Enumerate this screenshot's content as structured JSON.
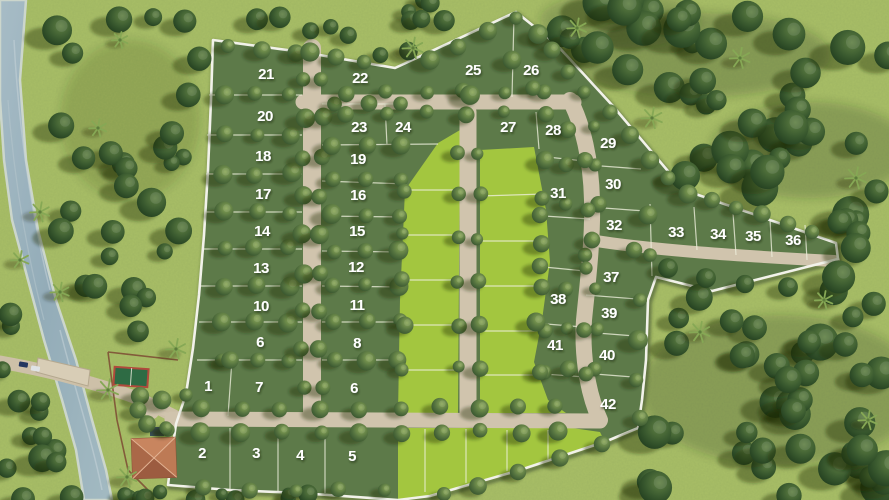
{
  "map": {
    "lot_labels": [
      {
        "label": "1",
        "x": 208,
        "y": 391
      },
      {
        "label": "2",
        "x": 202,
        "y": 458
      },
      {
        "label": "3",
        "x": 256,
        "y": 458
      },
      {
        "label": "4",
        "x": 300,
        "y": 460
      },
      {
        "label": "5",
        "x": 352,
        "y": 461
      },
      {
        "label": "6",
        "x": 260,
        "y": 347
      },
      {
        "label": "6",
        "x": 354,
        "y": 393
      },
      {
        "label": "7",
        "x": 259,
        "y": 392
      },
      {
        "label": "8",
        "x": 357,
        "y": 348
      },
      {
        "label": "10",
        "x": 261,
        "y": 311
      },
      {
        "label": "11",
        "x": 357,
        "y": 310
      },
      {
        "label": "12",
        "x": 356,
        "y": 272
      },
      {
        "label": "13",
        "x": 261,
        "y": 273
      },
      {
        "label": "14",
        "x": 262,
        "y": 236
      },
      {
        "label": "15",
        "x": 357,
        "y": 236
      },
      {
        "label": "16",
        "x": 358,
        "y": 200
      },
      {
        "label": "17",
        "x": 263,
        "y": 199
      },
      {
        "label": "18",
        "x": 263,
        "y": 161
      },
      {
        "label": "19",
        "x": 358,
        "y": 164
      },
      {
        "label": "20",
        "x": 265,
        "y": 121
      },
      {
        "label": "21",
        "x": 266,
        "y": 79
      },
      {
        "label": "22",
        "x": 360,
        "y": 83
      },
      {
        "label": "23",
        "x": 359,
        "y": 132
      },
      {
        "label": "24",
        "x": 403,
        "y": 132
      },
      {
        "label": "25",
        "x": 473,
        "y": 75
      },
      {
        "label": "26",
        "x": 531,
        "y": 75
      },
      {
        "label": "27",
        "x": 508,
        "y": 132
      },
      {
        "label": "28",
        "x": 553,
        "y": 135
      },
      {
        "label": "29",
        "x": 608,
        "y": 148
      },
      {
        "label": "30",
        "x": 613,
        "y": 189
      },
      {
        "label": "31",
        "x": 558,
        "y": 198
      },
      {
        "label": "32",
        "x": 614,
        "y": 230
      },
      {
        "label": "33",
        "x": 676,
        "y": 237
      },
      {
        "label": "34",
        "x": 718,
        "y": 239
      },
      {
        "label": "35",
        "x": 753,
        "y": 241
      },
      {
        "label": "36",
        "x": 793,
        "y": 245
      },
      {
        "label": "37",
        "x": 611,
        "y": 282
      },
      {
        "label": "38",
        "x": 558,
        "y": 304
      },
      {
        "label": "39",
        "x": 609,
        "y": 318
      },
      {
        "label": "40",
        "x": 607,
        "y": 360
      },
      {
        "label": "41",
        "x": 555,
        "y": 350
      },
      {
        "label": "42",
        "x": 608,
        "y": 409
      }
    ],
    "colors": {
      "outside_grass": "#a9bf66",
      "inside_lot_green": "#5d7a49",
      "open_lot_green": "#a3c63f",
      "road_beige": "#d0c4ad",
      "river_blue": "#9db4bf",
      "fence_white": "#f2f2ea",
      "court_green": "#2e6b44",
      "court_border_red": "#b04a3c",
      "roof_terracotta": "#b4714f",
      "label_text": "#ffffff"
    }
  }
}
